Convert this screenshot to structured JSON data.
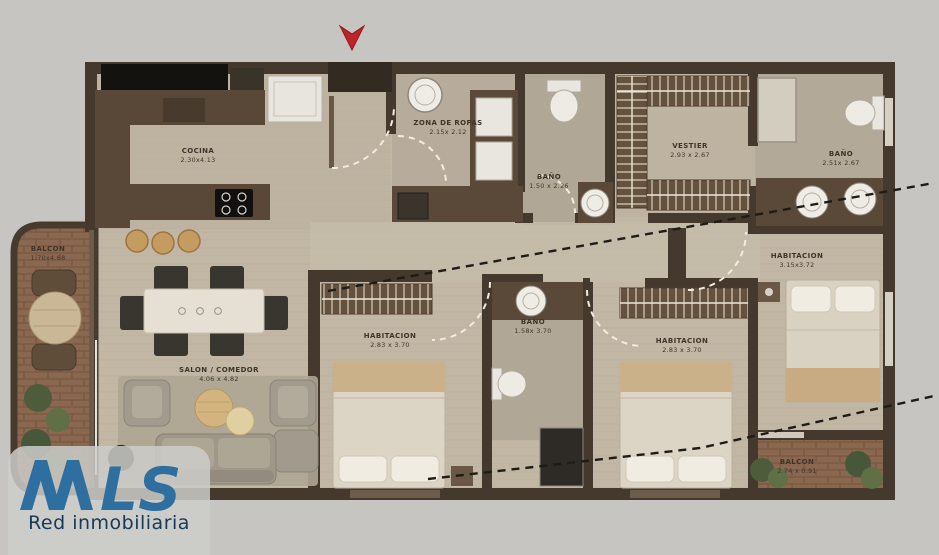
{
  "page": {
    "background": "#c6c5c2"
  },
  "plan": {
    "wall_color": "#45392d",
    "floor_color": "#c2b7a5",
    "brick_color": "#8a6750",
    "door_arc_color": "#f1ece0",
    "leader_line_color": "#1f1c17"
  },
  "entrance": {
    "marker": "down-arrow",
    "color": "#c0232a"
  },
  "rooms": [
    {
      "id": "cocina",
      "name": "COCINA",
      "dims": "2.30x4.13"
    },
    {
      "id": "zona-de-ropas",
      "name": "ZONA DE ROPAS",
      "dims": "2.15x 2.12"
    },
    {
      "id": "bano-zona",
      "name": "BAÑO",
      "dims": "1.50 x 2.26"
    },
    {
      "id": "vestier",
      "name": "VESTIER",
      "dims": "2.93 x 2.67"
    },
    {
      "id": "bano-principal",
      "name": "BAÑO",
      "dims": "2.51x 2.67"
    },
    {
      "id": "habitacion-principal",
      "name": "HABITACION",
      "dims": "3.15x3.72"
    },
    {
      "id": "bano-central",
      "name": "BAÑO",
      "dims": "1.58x 3.70"
    },
    {
      "id": "habitacion-2",
      "name": "HABITACION",
      "dims": "2.83 x 3.70"
    },
    {
      "id": "habitacion-3",
      "name": "HABITACION",
      "dims": "2.83 x 3.70"
    },
    {
      "id": "salon-comedor",
      "name": "SALON / COMEDOR",
      "dims": "4.06 x 4.82"
    },
    {
      "id": "balcon-salon",
      "name": "BALCON",
      "dims": "1.70x4.68"
    },
    {
      "id": "balcon-habitacion",
      "name": "BALCON",
      "dims": "2.74 x 0.91"
    }
  ],
  "logo": {
    "brand": "MLS",
    "brand_suffix": "LS",
    "tagline": "Red inmobiliaria",
    "blue": "#2e6f9f",
    "navy": "#17395a"
  }
}
